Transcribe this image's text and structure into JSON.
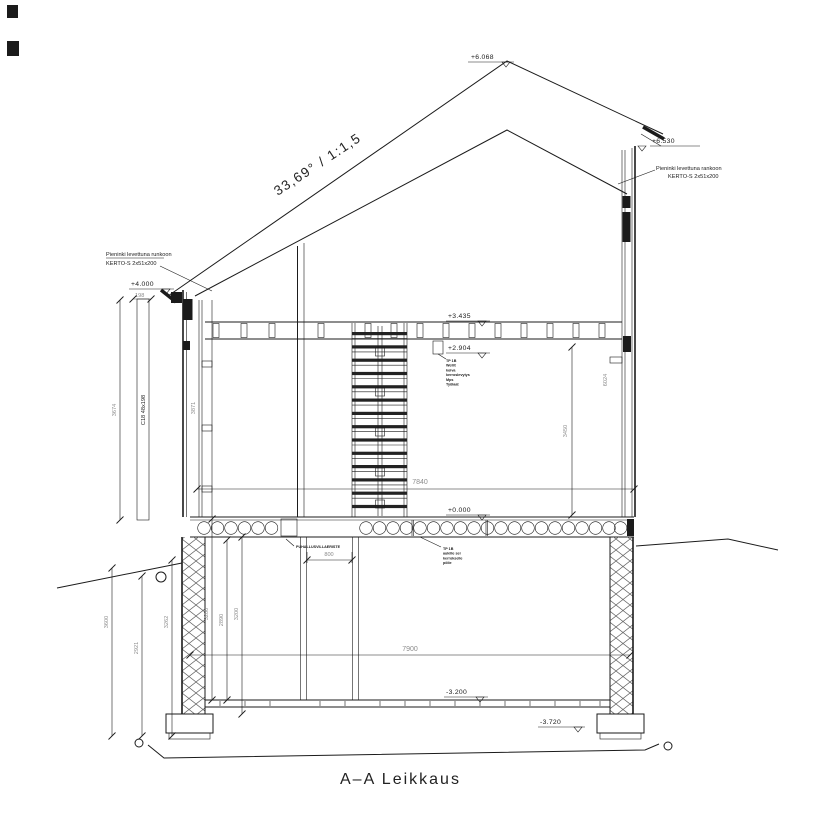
{
  "title": "A–A Leikkaus",
  "roof": {
    "slope": "33,69° / 1:1,5"
  },
  "levels": {
    "ridge": "+6.068",
    "eave_right": "+6.530",
    "wall_top_left": "+4.000",
    "ceiling_top": "+3.435",
    "ceiling_bottom": "+2.904",
    "floor_ground": "+0.000",
    "floor_basement": "-3.200",
    "footing": "-3.720"
  },
  "notes": {
    "kerto_left": {
      "line1": "Pieninki levettuna runkoon",
      "line2": "KERTO-S 2x51x200"
    },
    "kerto_right": {
      "line1": "Pieninki levettuna rankoon",
      "line2": "KERTO-S 2x51x200"
    },
    "column": "C18 48x198",
    "insulation": "PUHALLUSVILLAERISTE",
    "floor_note": {
      "l1": "TP 1B",
      "l2": "Wellit",
      "l3": "koiva",
      "l4": "kerroslevytys",
      "l5": "Mps",
      "l6": "Työlaat"
    },
    "slab_note": {
      "l1": "TP 1B",
      "l2": "aukille sei",
      "l3": "kerrokselle",
      "l4": "pölie"
    }
  },
  "dims": {
    "d198": "198",
    "d3674": "3674",
    "d3871": "3871",
    "d3450": "3450",
    "d6024": "6024",
    "d7840": "7840",
    "d7900": "7900",
    "d800": "800",
    "d3600": "3600",
    "d2921": "2921",
    "d3262": "3262",
    "d3200a": "3200",
    "d2890": "2890",
    "d3200b": "3200"
  },
  "colors": {
    "line": "#1b1b1b",
    "dim_text": "#8c8c8c"
  }
}
